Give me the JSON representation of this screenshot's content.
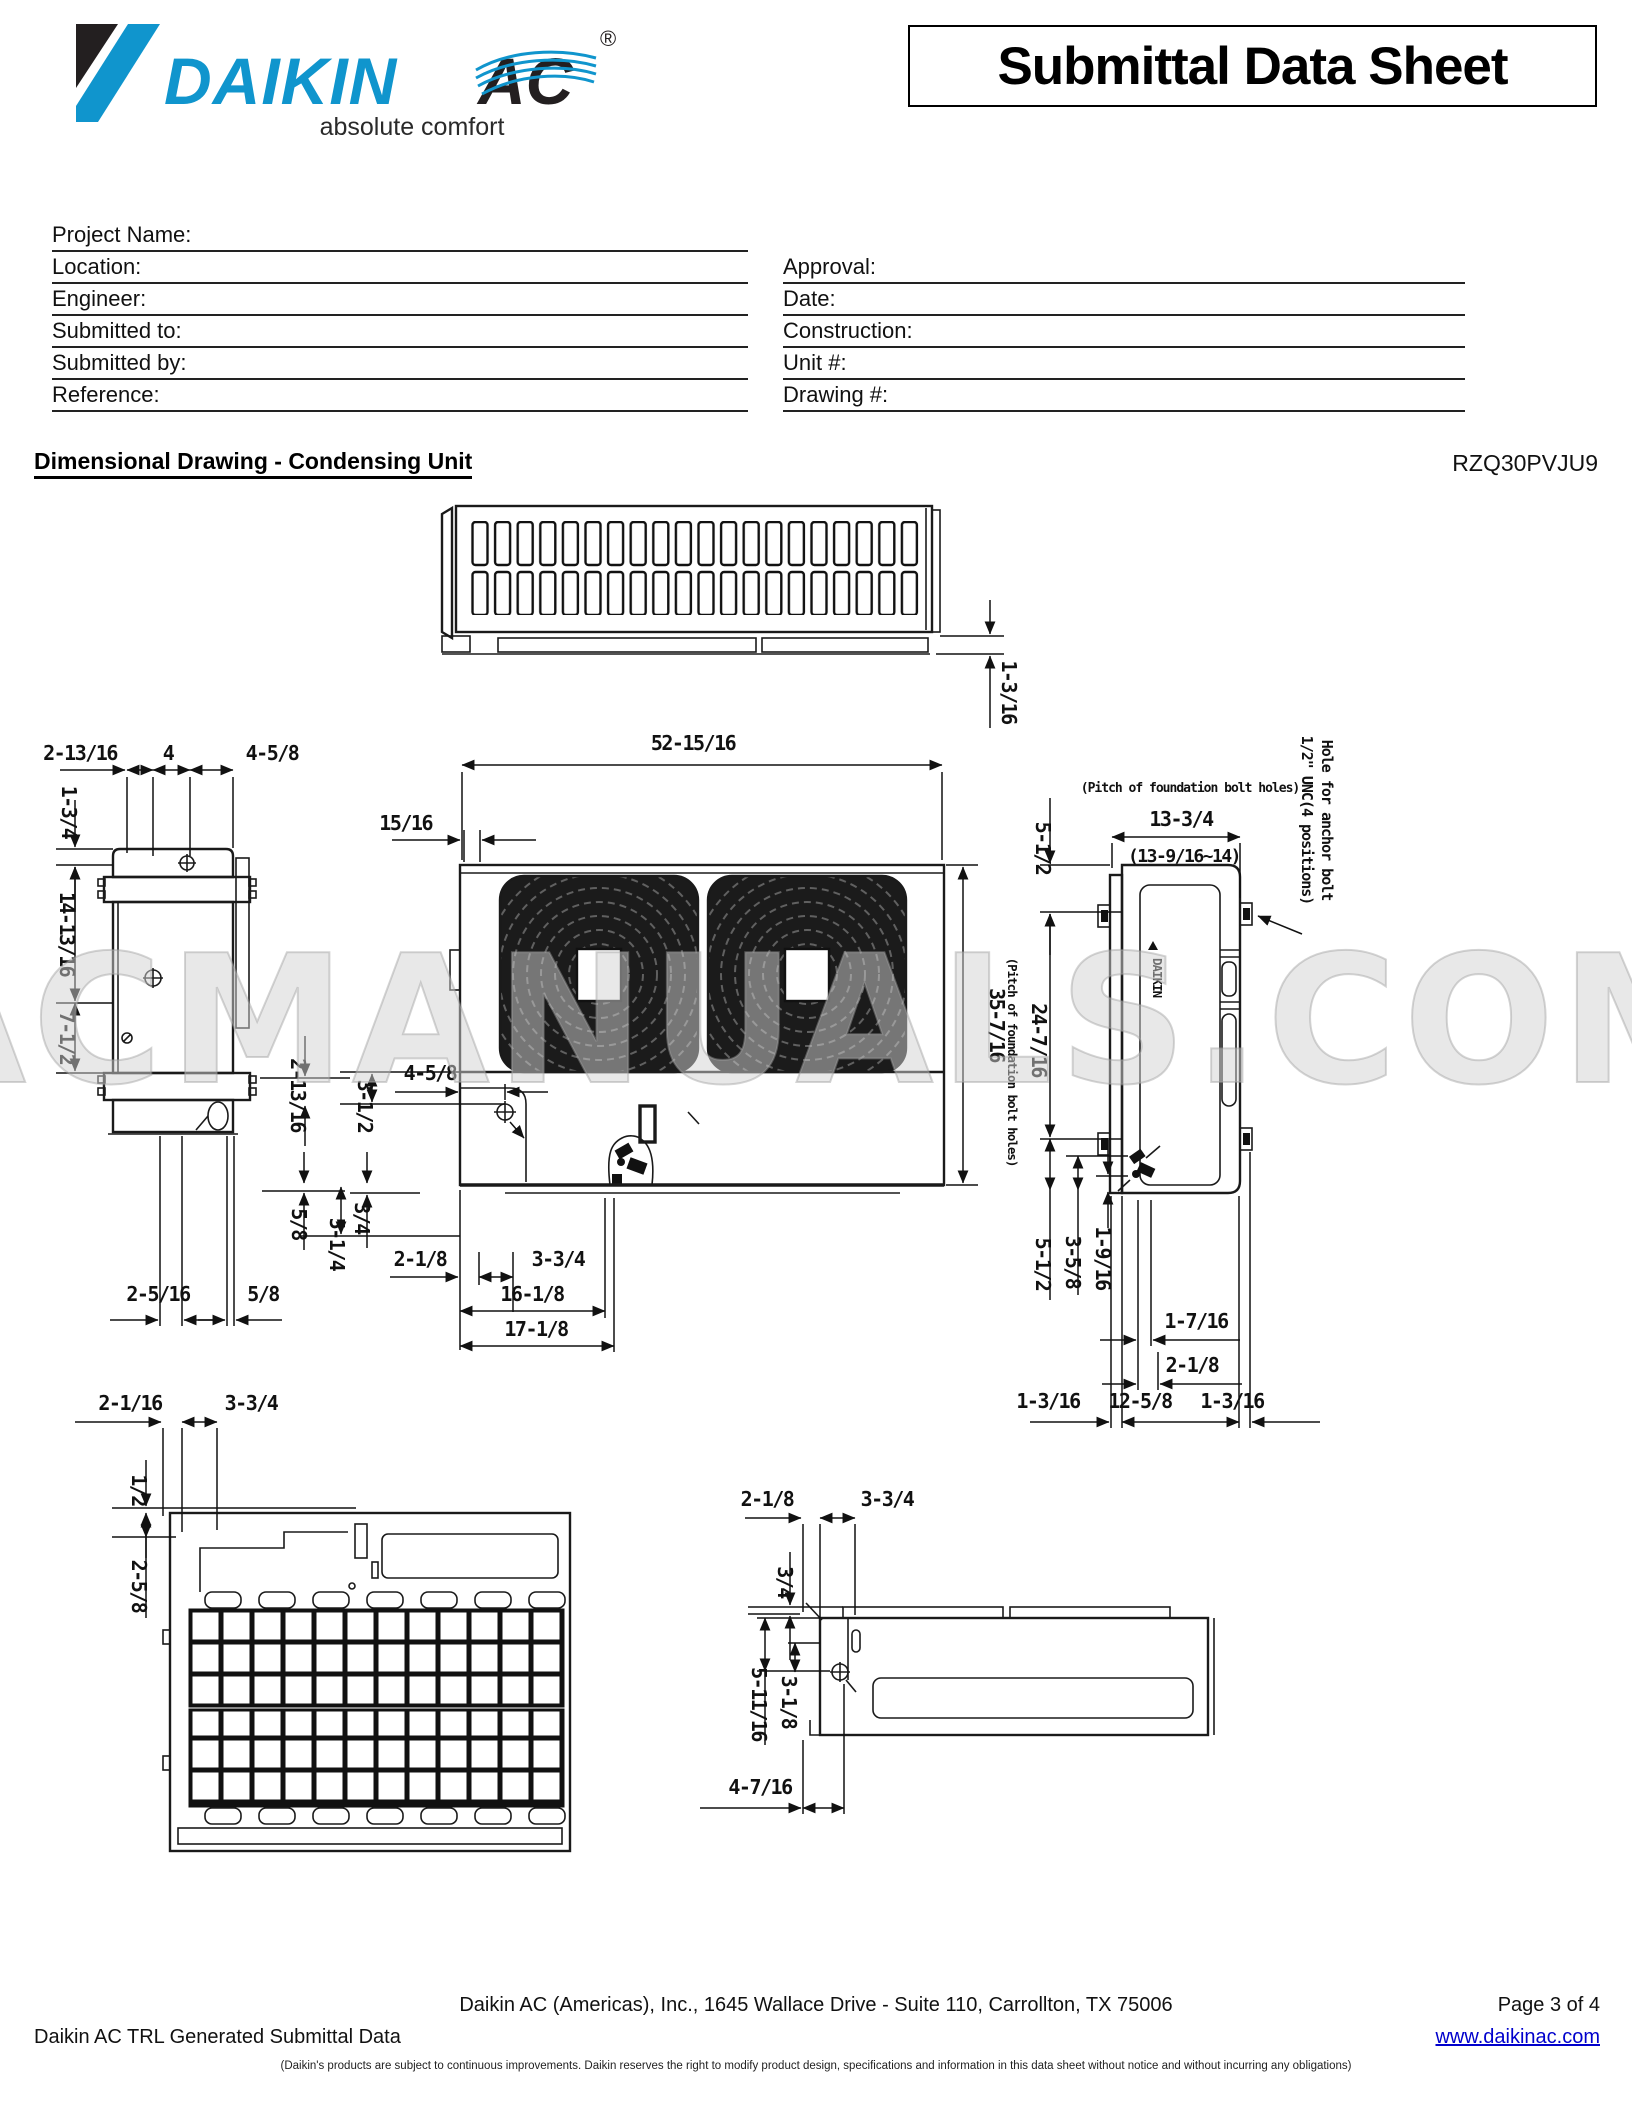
{
  "header": {
    "logo": {
      "brand": "DAIKIN",
      "suffix": "AC",
      "registered": "®",
      "tagline": "absolute comfort",
      "blue": "#1095cd",
      "black": "#231f20"
    },
    "title": "Submittal Data Sheet"
  },
  "form": {
    "left": [
      "Project Name:",
      "Location:",
      "Engineer:",
      "Submitted to:",
      "Submitted by:",
      "Reference:"
    ],
    "right": [
      "Approval:",
      "Date:",
      "Construction:",
      "Unit #:",
      "Drawing #:"
    ]
  },
  "section": {
    "title": "Dimensional Drawing - Condensing Unit",
    "model": "RZQ30PVJU9"
  },
  "drawing": {
    "watermark": "ACMANUALS.COM",
    "notes": {
      "pitch_h": "(Pitch of foundation bolt holes)",
      "pitch_v": "(Pitch of foundation bolt holes)",
      "anchor1": "Hole for anchor bolt",
      "anchor2": "1/2\" UNC(4 positions)"
    },
    "dims": {
      "tv_gap": "1-3/16",
      "fv_w": "52-15/16",
      "fv_seam": "15/16",
      "fv_h": "35-7/16",
      "fv_458": "4-5/8",
      "fv_312": "3-1/2",
      "fv_21316": "2-13/16",
      "fv_58": "5/8",
      "fv_34": "3/4",
      "fv_514": "5-1/4",
      "fv_218": "2-1/8",
      "fv_334": "3-3/4",
      "fv_1618": "16-1/8",
      "fv_1718": "17-1/8",
      "sv_21316": "2-13/16",
      "sv_4": "4",
      "sv_458": "4-5/8",
      "sv_134": "1-3/4",
      "sv_141316": "14-13/16",
      "sv_712": "7-1/2",
      "sv_2516": "2-5/16",
      "sv_58": "5/8",
      "rv_1334": "13-3/4",
      "rv_13916": "(13-9/16~14)",
      "rv_512t": "5-1/2",
      "rv_24716": "24-7/16",
      "rv_512b": "5-1/2",
      "rv_358": "3-5/8",
      "rv_1916": "1-9/16",
      "rv_1716": "1-7/16",
      "rv_218": "2-1/8",
      "rv_1316l": "1-3/16",
      "rv_1258": "12-5/8",
      "rv_1316r": "1-3/16",
      "bv_2116": "2-1/16",
      "bv_334": "3-3/4",
      "bv_12": "1/2",
      "bv_258": "2-5/8",
      "pv_218": "2-1/8",
      "pv_334": "3-3/4",
      "pv_34": "3/4",
      "pv_51116": "5-11/16",
      "pv_318": "3-1/8",
      "pv_4716": "4-7/16"
    }
  },
  "footer": {
    "address": "Daikin AC (Americas), Inc., 1645 Wallace Drive - Suite 110, Carrollton, TX 75006",
    "page": "Page 3 of 4",
    "generated": "Daikin AC TRL Generated Submittal Data",
    "website": "www.daikinac.com",
    "disclaimer": "(Daikin's products are subject to continuous improvements.  Daikin reserves the right to modify product design, specifications and information in this data sheet without notice and without incurring any obligations)"
  }
}
